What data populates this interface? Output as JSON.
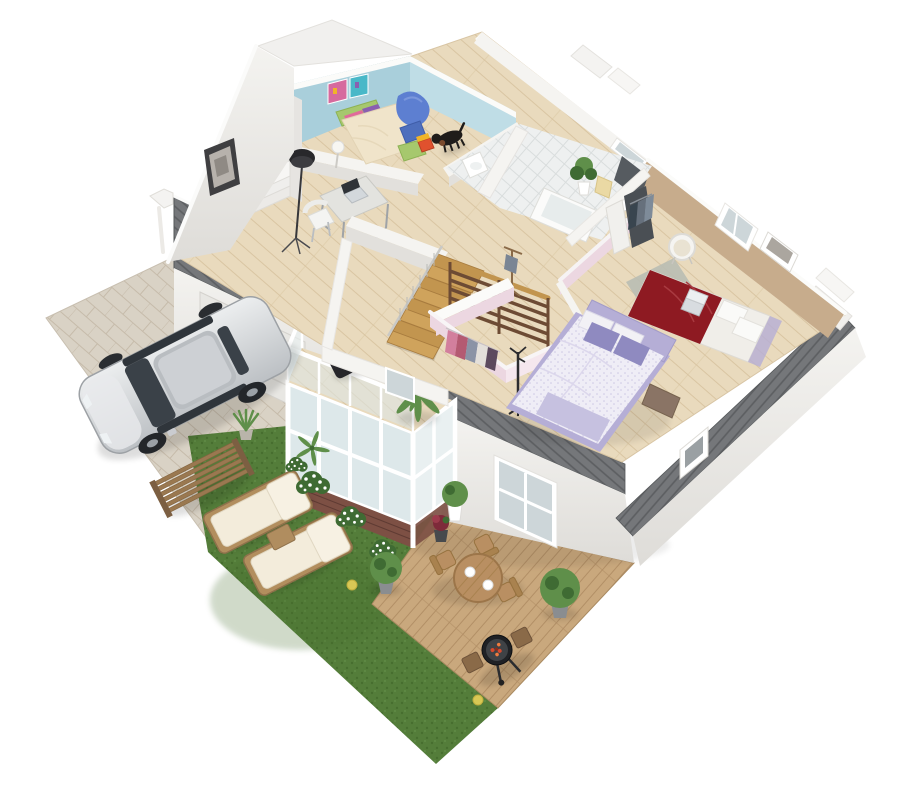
{
  "scene": {
    "title": "3D isometric floor plan render — upper floor cutaway with kids bedroom, bathroom, staircase, walk-in closet, two bedrooms, balcony, garage, driveway with silver SUV, lawn and wooden deck",
    "view": "isometric cutaway from above",
    "background": "white"
  },
  "palette": {
    "bg": "#ffffff",
    "floorWood": "#e9dabd",
    "floorWoodLine": "#d9c5a2",
    "wallWhite": "#f5f4f1",
    "wallShade": "#e2e0dc",
    "wallEdge": "#d2cfca",
    "wallTop": "#fbfbf9",
    "blueWall": "#a9cfdb",
    "blueWallLight": "#bfdde6",
    "pinkWall": "#ecd7e1",
    "pinkWallLight": "#f5e7ee",
    "tanWall": "#c7ac8c",
    "tanWallDark": "#b59877",
    "grayRoof": "#75777a",
    "grayRoofLine": "#5c5e61",
    "grass": "#547d3a",
    "grassDark": "#476e2f",
    "grassLight": "#639049",
    "deckWood": "#c9a87d",
    "deckLine": "#b28f66",
    "paver": "#d9d2c5",
    "paverLine": "#c6bbaa",
    "brick": "#7d5044",
    "brickLine": "#5f3b33",
    "glass": "#dde8ea",
    "glassDark": "#cdd6d9",
    "carBody": "#d6d8da",
    "carEdge": "#9da1a5",
    "carGlass": "#3a4148",
    "stairWood": "#c2954f",
    "stairWoodDark": "#a87c3f",
    "railBrown": "#6d4b34",
    "bedGreen": "#a6c86d",
    "bedGreenDark": "#8db254",
    "bedCream": "#f0e4ca",
    "beanBlue": "#5d7fd1",
    "beanBlueDark": "#4e6fbd",
    "purplePillow": "#8f8ac0",
    "lavender": "#b5aed6",
    "lavenderLight": "#c6c1e0",
    "duvetWhite": "#efedf6",
    "duvetDot": "#cdc8e4",
    "redBed": "#8e1a22",
    "blackItem": "#26262a",
    "plantGreen": "#5f8f4a",
    "plantDark": "#3f6b33",
    "tileFloor": "#eef0f0",
    "tileLine": "#d9dddd",
    "rugGray": "#b9bdb2",
    "yellowBall": "#d8c855",
    "white": "#ffffff"
  },
  "house": {
    "rooms": [
      {
        "name": "Kids bedroom",
        "wall_color": "light blue",
        "items": [
          "green single bed with cream duvet",
          "pink and purple pillows",
          "colorful wall posters",
          "blue bean bag chair",
          "blue cube seat",
          "toy cube",
          "white floor lamp",
          "dog"
        ]
      },
      {
        "name": "Study landing",
        "items": [
          "white bookshelf with colorful books",
          "black drum floor lamp",
          "desk with laptop",
          "white chair",
          "framed picture on gable wall"
        ]
      },
      {
        "name": "Bathroom",
        "floor": "white tile",
        "items": [
          "bathtub",
          "dark vanity with sink",
          "potted plant",
          "cream towels",
          "toilet"
        ]
      },
      {
        "name": "Staircase",
        "items": [
          "open wooden stairs",
          "cable balustrade",
          "dark wood slat railing"
        ]
      },
      {
        "name": "Hallway",
        "items": [
          "wooden valet stand"
        ]
      },
      {
        "name": "Walk-in closet",
        "wall_color": "pink",
        "items": [
          "hanging clothes",
          "black coat stand"
        ]
      },
      {
        "name": "Master bedroom",
        "wall_color": "pink",
        "items": [
          "double bed with white patterned duvet",
          "purple pillows",
          "lavender throw",
          "brown ottoman"
        ]
      },
      {
        "name": "Bedroom 2",
        "wall_color": "taupe",
        "items": [
          "double bed with dark red duvet",
          "laptop on bed",
          "grey rug",
          "white wicker chair",
          "open wardrobe with hanging clothes",
          "window",
          "framed art"
        ]
      }
    ],
    "exterior": [
      "grey striped eaves",
      "white walls with windows",
      "balcony with black lounger and palm",
      "glass sunroom with brick base",
      "garage with grey pitched roof",
      "white downpipes",
      "roof guard rail"
    ]
  },
  "outdoor": {
    "driveway": {
      "surface": "stone pavers",
      "vehicle": "silver SUV"
    },
    "lawn": [
      "two wooden sun loungers with white cushions",
      "wooden side table",
      "slatted garden bench",
      "white flower shrubs",
      "potted round bush",
      "yellow ball",
      "agave pot"
    ],
    "deck": [
      "round wooden dining table",
      "three wooden chairs",
      "two white plates",
      "charcoal barbecue grill",
      "potted round bushes",
      "flower pots",
      "yellow ball"
    ]
  }
}
